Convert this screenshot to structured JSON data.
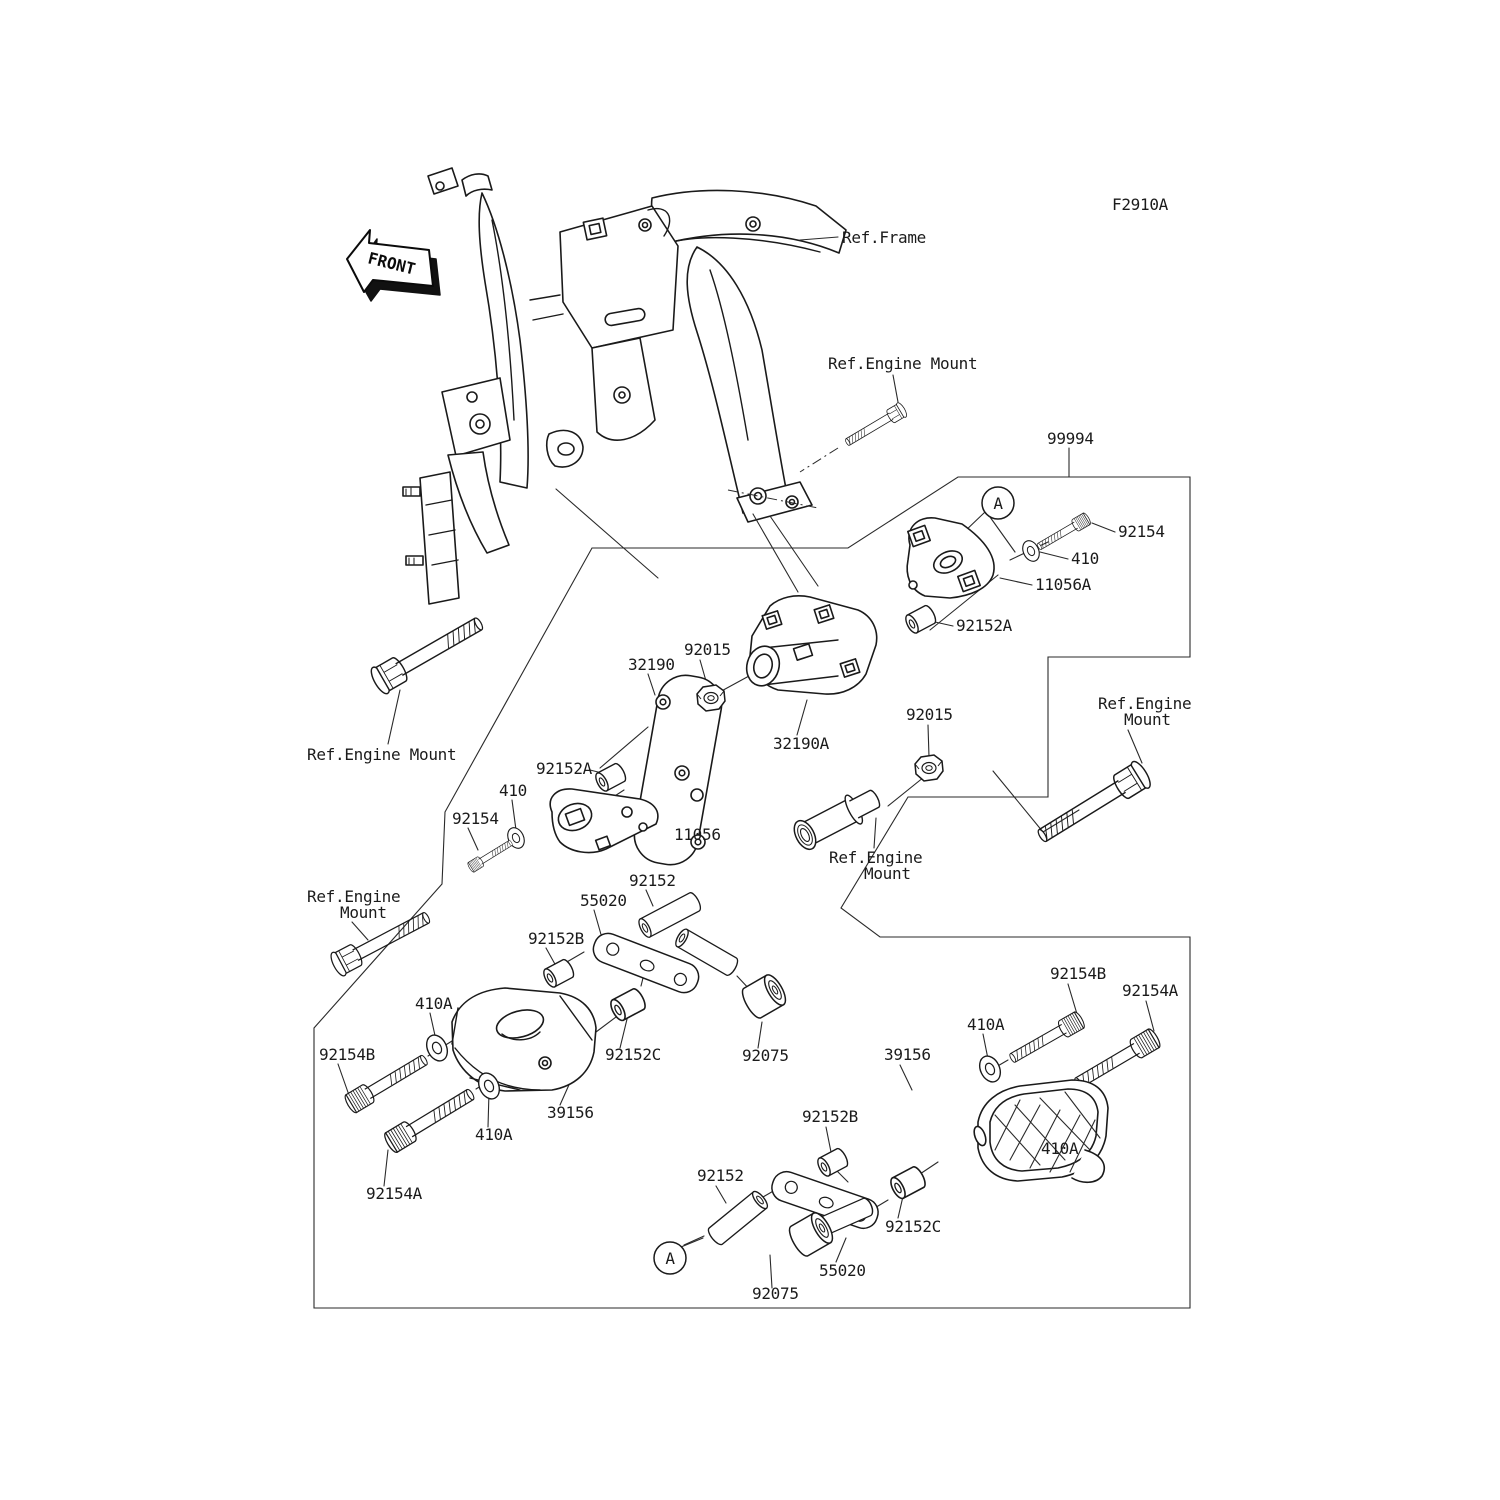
{
  "diagram": {
    "code": "F2910A",
    "orientation_arrow": "FRONT",
    "detail_marker": "A"
  },
  "references": {
    "frame": "Ref.Frame",
    "engine_mount": "Ref.Engine Mount",
    "engine_mount_line1": "Ref.Engine",
    "engine_mount_line2": "Mount"
  },
  "parts": {
    "kit": "99994",
    "bolt_small": "92154",
    "washer": "410",
    "bracket_right": "11056A",
    "bushing_a": "92152A",
    "nut": "92015",
    "plate": "32190",
    "bracket_pipe": "32190A",
    "bracket_left": "11056",
    "spacer": "92152",
    "link_plate": "55020",
    "bushing_b": "92152B",
    "bushing_c": "92152C",
    "damper": "92075",
    "guard": "39156",
    "washer_a": "410A",
    "bolt_a": "92154A",
    "bolt_b": "92154B"
  }
}
